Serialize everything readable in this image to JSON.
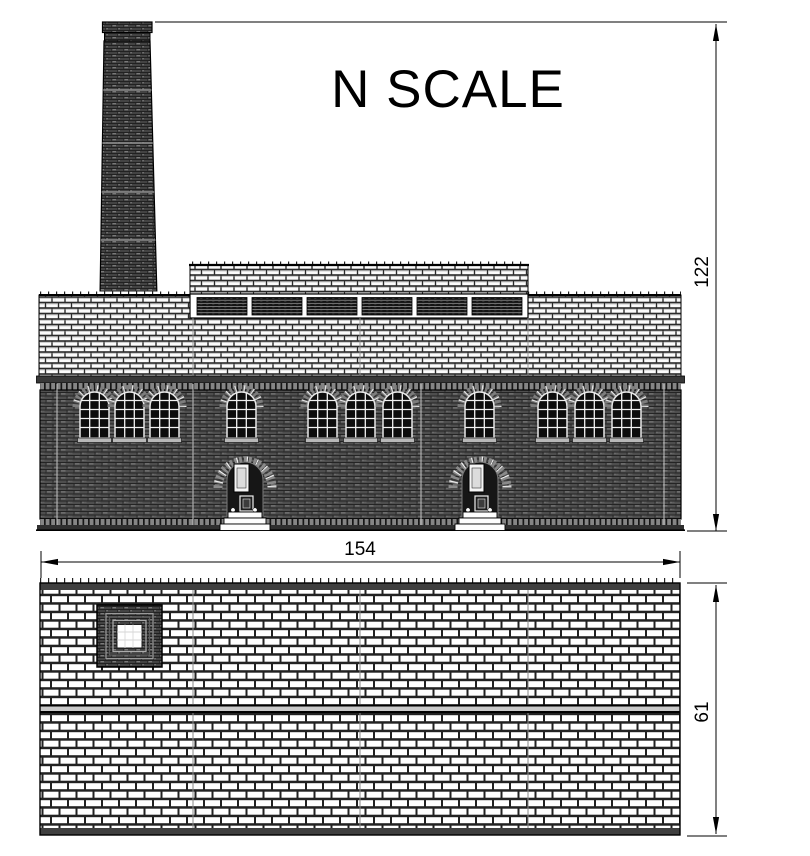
{
  "title": "N SCALE",
  "dimensions": {
    "height_label": "122",
    "width_label": "154",
    "depth_label": "61"
  },
  "colors": {
    "ink": "#000000",
    "paper": "#ffffff",
    "dark_wall": "#4d4d4d",
    "light_masonry": "#fafafa"
  },
  "elevation": {
    "window_lefts": [
      80,
      115,
      150,
      227,
      308,
      346,
      383,
      465,
      538,
      575,
      612
    ],
    "door_centers": [
      245,
      480
    ],
    "clerestory_panel_lefts": [
      197,
      252,
      307,
      362,
      417,
      472
    ],
    "wall_seam_xs": [
      57,
      193,
      421,
      664
    ],
    "chimney_band_ys": [
      90,
      143,
      192,
      240
    ]
  },
  "plan": {
    "panel_joint_xs": [
      193,
      360,
      528
    ]
  }
}
